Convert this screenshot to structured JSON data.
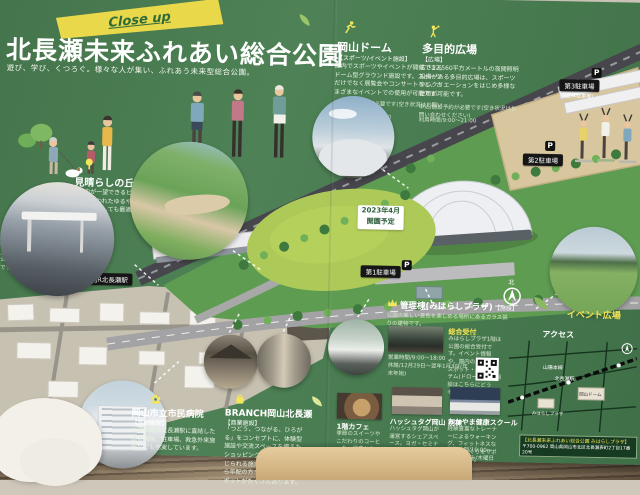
{
  "banner": {
    "close_up": "Close up"
  },
  "header": {
    "title": "北長瀬未来ふれあい総合公園",
    "subtitle": "遊び、学び、くつろぐ。様々な人が集い、ふれあう未来型総合公園。"
  },
  "map": {
    "station_label": "JR北長瀬駅",
    "parking1": "第1駐車場",
    "parking2": "第2駐車場",
    "parking3": "第3駐車場",
    "parking3_sub": "(立体駐車場)",
    "p": "P",
    "north": "北",
    "opening_line1": "2023年4月",
    "opening_line2": "開園予定"
  },
  "sections": {
    "dome": {
      "name": "岡山ドーム",
      "tag": "【スポーツ/イベント施設】",
      "desc": "屋内でスポーツやイベントが開催できるドーム型グラウンド施設です。スポーツだけでなく展覧会やコンサートなど、さまざまなイベントでの使用が可能です。",
      "info1": "申込/施設予約が必要です(空き状況はお問い合わせください)",
      "info2": "利用時間/9:00〜21:00"
    },
    "plaza": {
      "name": "多目的広場",
      "tag": "【広場】",
      "desc": "広さ12,560平方メートルの夜間照明設備がある多目的広場は、スポーツやレクリエーションをはじめ多様な使用が可能です。",
      "info1": "申込/施設予約が必要です(空き状況はお問い合わせください)",
      "info2": "利用時間/9:00〜21:00"
    },
    "hill": {
      "name": "見晴らしの丘",
      "desc": "公園内が一望できるビューポイント。天然芝で覆われたゆるやかな丘は、お子様の遊び場としても最適です。"
    },
    "station_caption": "山陽本線「北長瀬駅」。改札を出ると公園はすぐ目の前です。",
    "management": {
      "name": "管理棟(みはらしプラザ)",
      "tag": "【施設】",
      "desc": "公園の美しい景色を楽しめる場所にあるガラス張りの建物です。",
      "reception": "総合受付",
      "reception_desc": "みはらしプラザ1階は公園の総合受付です。イベント情報や、園内の人気撮影スポット・撮影アイテム(ドローン等)の相談はこちらにどうぞ。",
      "hours": "営業時間/9:00〜18:00",
      "closed": "休館/12月29日〜翌年1月3日(年末年始)"
    },
    "event_plaza": "イベント広場",
    "hospital": {
      "name": "岡山市立市民病院",
      "tag": "【医療機関】",
      "desc": "山陽本線JR北長瀬駅に直結した総合病院。駐車場、救急外来施設なども充実しています。"
    },
    "branch": {
      "name": "BRANCH岡山北長瀬",
      "tag": "【商業施設】",
      "desc": "「つどう、つながる、ひろがる」をコンセプトに、体験型施設や交流スペースを備えたショッピング施設。自然が感じられる施設内は、子どもから年配の方までおすすめのスポットがたくさんあります。"
    },
    "cafe": {
      "name": "1階カフェ",
      "desc": "季節のスイーツやこだわりのコーヒーを、緑豊かな「杜」を眺めながら楽しめる憩いの場。",
      "hours": "営業時間/10:00〜18:00"
    },
    "hashtag": {
      "name": "ハッシュタグ岡山 別棟",
      "desc": "ハッシュタグ岡山が運営するシェアスペース。ヨガ・セミナーなど様々な用途のイベントに利用いただけます。",
      "hours": "営業時間/9:00〜21:00"
    },
    "school": {
      "name": "おかやま健康スクール",
      "desc": "経験豊富なトレーナーによるウォーキング、フィットネスなど健康づくりをサポートします。",
      "hours": "営業時間/10:00〜21:00 休み/木曜日"
    }
  },
  "access": {
    "title": "アクセス",
    "labels": {
      "line": "山陽本線",
      "station": "北長瀬駅",
      "dome": "岡山ドーム",
      "plaza": "みはらしプラザ"
    },
    "footer1": "【北長瀬未来ふれあい総合公園 みはらしプラザ】",
    "footer2": "〒700-0962 岡山県岡山市北区北長瀬表町2丁目17番20号"
  }
}
